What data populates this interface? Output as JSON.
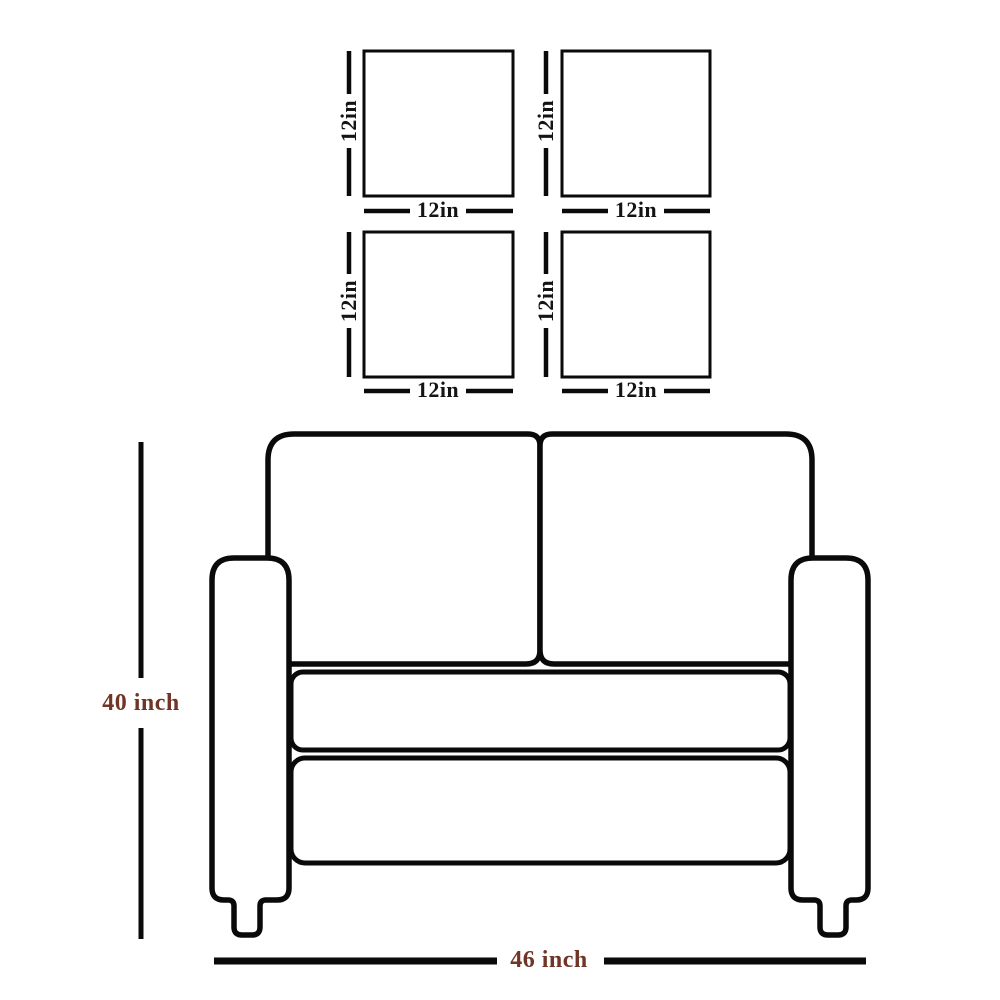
{
  "diagram_title": "loveseat-dimension-diagram",
  "colors": {
    "outline": "#0a0a0a",
    "pillow_label": "#141414",
    "dimension_label": "#703526",
    "background": "#ffffff"
  },
  "pillows": [
    {
      "name": "top-left",
      "height_label": "12in",
      "width_label": "12in"
    },
    {
      "name": "top-right",
      "height_label": "12in",
      "width_label": "12in"
    },
    {
      "name": "bottom-left",
      "height_label": "12in",
      "width_label": "12in"
    },
    {
      "name": "bottom-right",
      "height_label": "12in",
      "width_label": "12in"
    }
  ],
  "sofa": {
    "height_label": "40 inch",
    "width_label": "46 inch"
  }
}
